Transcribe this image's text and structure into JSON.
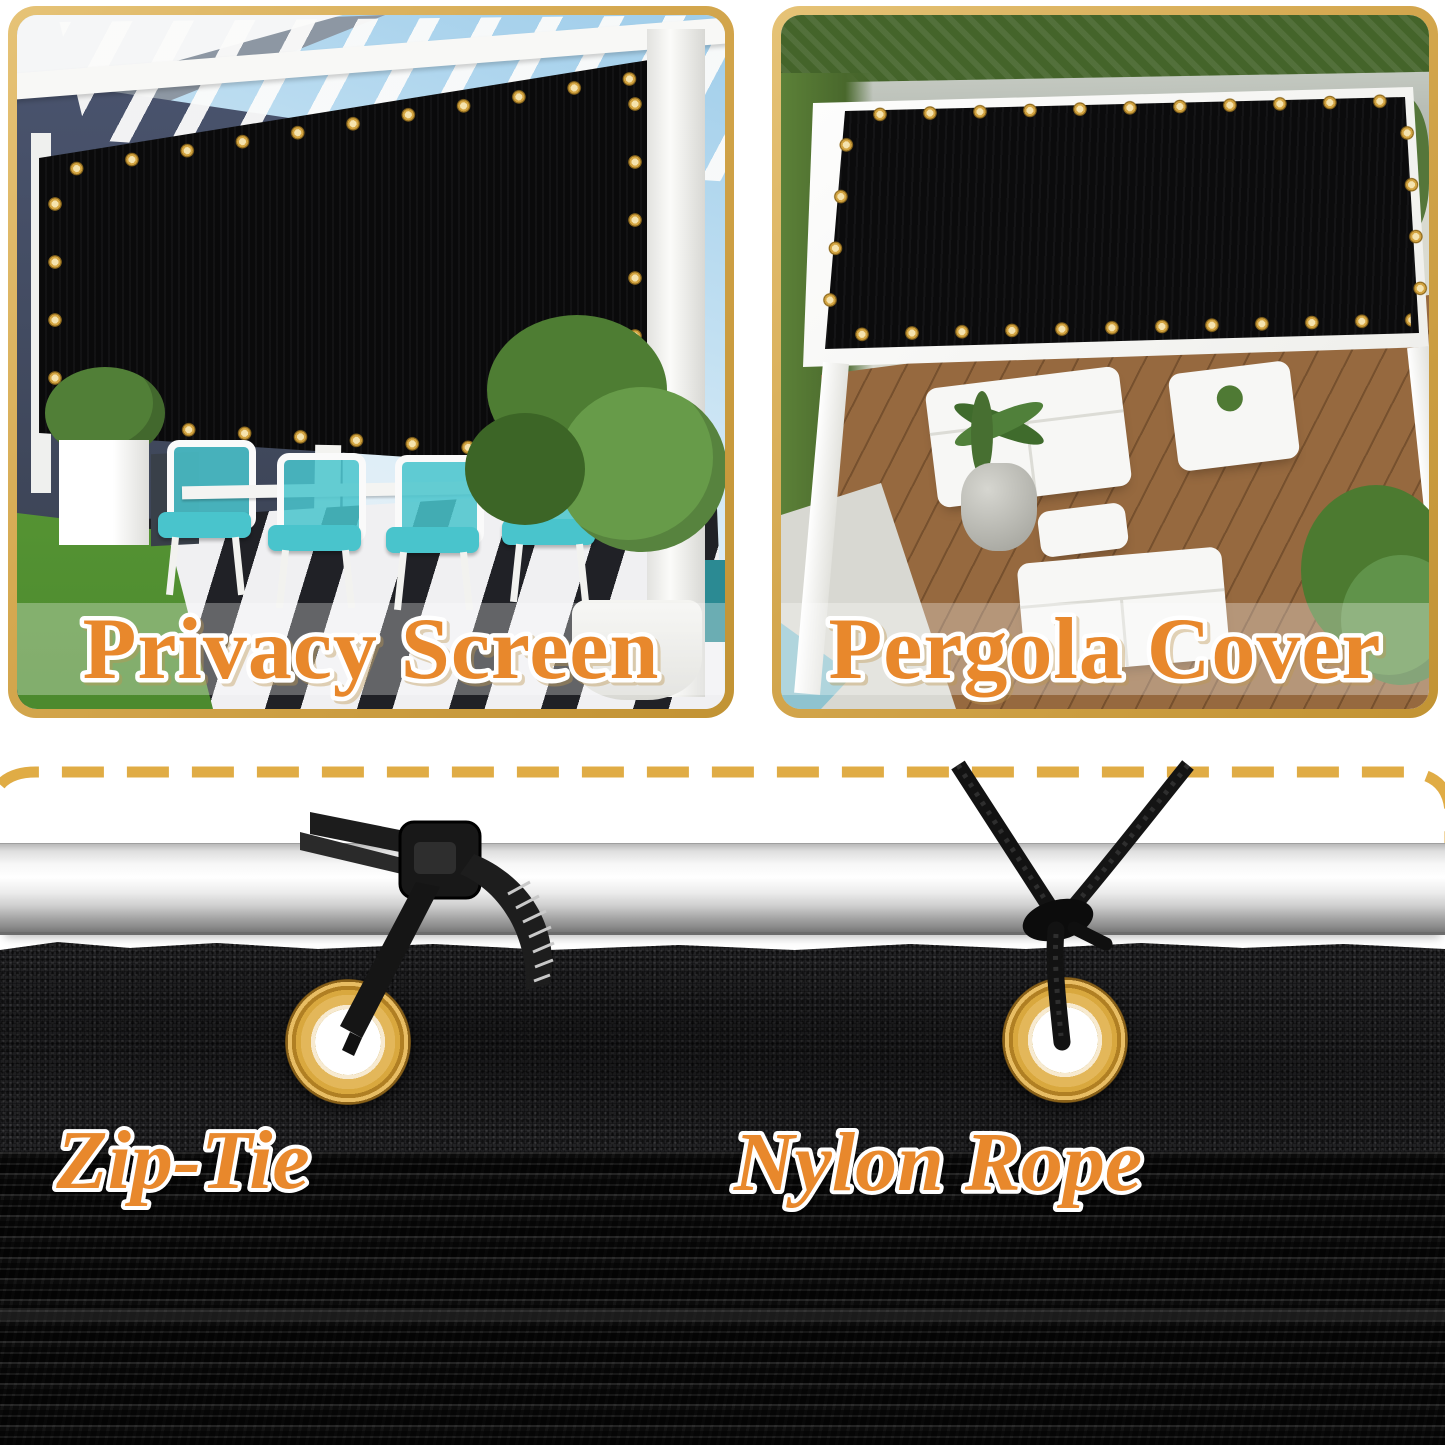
{
  "panels": {
    "privacy_screen": {
      "label": "Privacy Screen"
    },
    "pergola_cover": {
      "label": "Pergola Cover"
    }
  },
  "installation": {
    "zip_tie_label": "Zip-Tie",
    "nylon_rope_label": "Nylon Rope"
  },
  "objects": {
    "left_fastener": "zip-tie",
    "right_fastener": "nylon-rope",
    "hardware": "brass-grommet",
    "support": "metal-pole",
    "material": "black-shade-mesh"
  },
  "colors": {
    "frame_gold": "#D5A84C",
    "dashed_line_gold": "#E0AC45",
    "label_orange": "#E8882C",
    "label_outline": "#FFFFFF",
    "grommet_brass": "#D9A83E",
    "fabric_black": "#111111",
    "pole_silver": "#DADADA",
    "cushion_teal": "#49C4CC"
  }
}
